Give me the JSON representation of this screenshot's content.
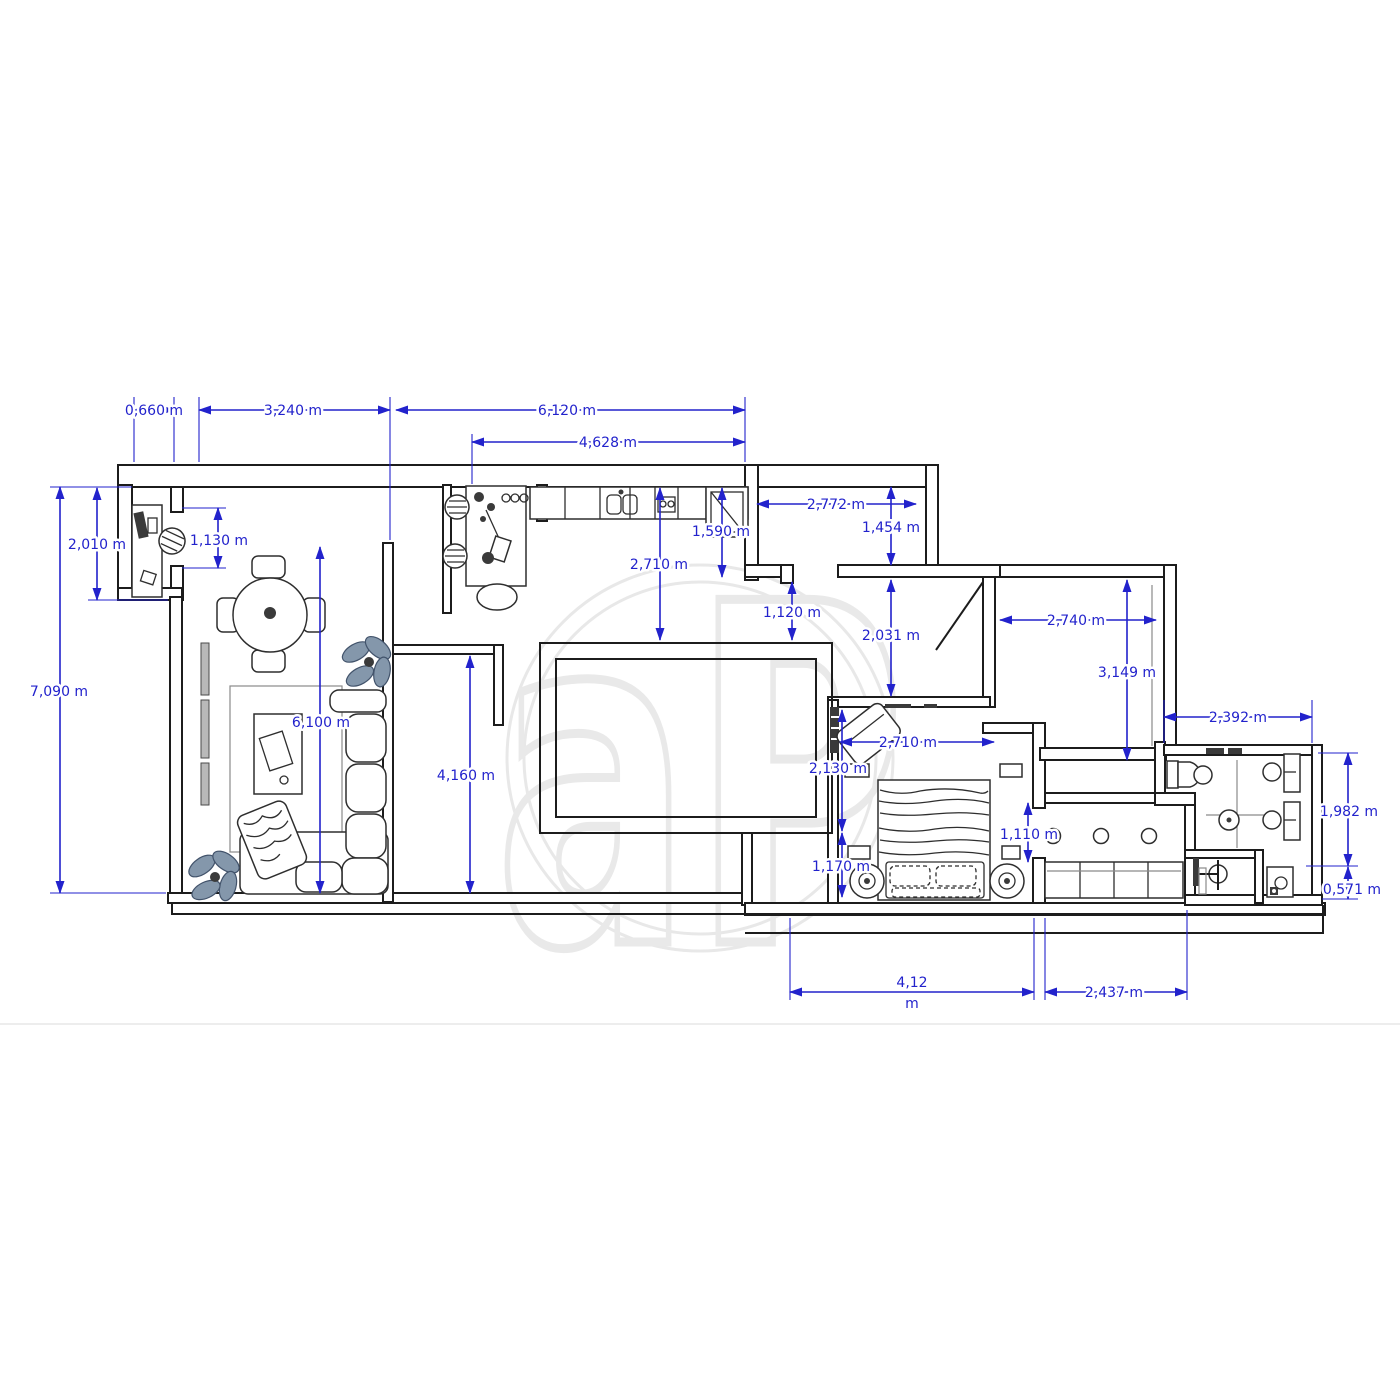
{
  "page": {
    "background": "#ffffff"
  },
  "watermark": {
    "text": "aP",
    "color": "#e9e9e9"
  },
  "colors": {
    "dimension_blue": "#2222cc",
    "wall_black": "#1c1c1c",
    "plant_fill": "#8497ab"
  },
  "dims": {
    "d0660": "0,660 m",
    "d3240": "3,240 m",
    "d6120": "6,120 m",
    "d4628": "4,628 m",
    "d2010": "2,010 m",
    "d1130": "1,130 m",
    "d7090": "7,090 m",
    "d2710_kitchen": "2,710 m",
    "d1590": "1,590 m",
    "d2772": "2,772 m",
    "d1454": "1,454 m",
    "d1120": "1,120 m",
    "d2031": "2,031 m",
    "d2740": "2,740 m",
    "d3149": "3,149 m",
    "d2392": "2,392 m",
    "d1982": "1,982 m",
    "d0571": "0,571 m",
    "d2710_bedroom": "2,710 m",
    "d2130": "2,130 m",
    "d1170": "1,170 m",
    "d1110": "1,110 m",
    "d4160": "4,160 m",
    "d6100": "6,100 m",
    "d412_value": "4,12",
    "d412_unit": "m",
    "d2437": "2,437 m"
  }
}
